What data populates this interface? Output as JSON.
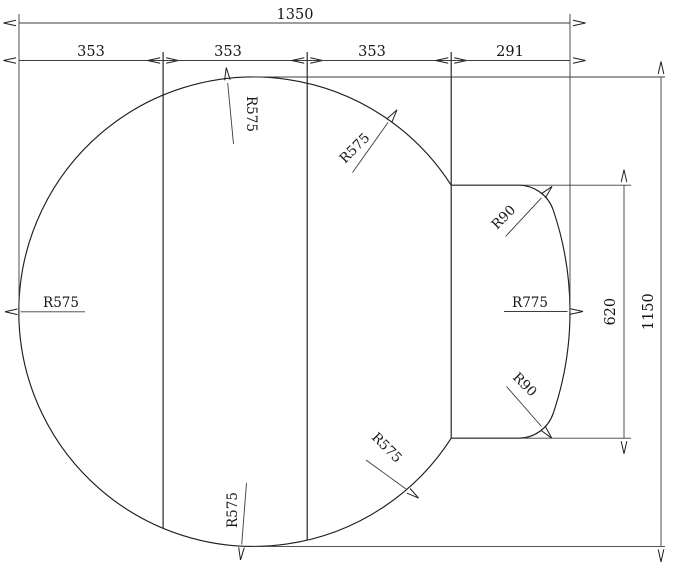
{
  "drawing": {
    "background_color": "#ffffff",
    "line_color": "#1e1e1e",
    "dims": {
      "overall_width": "1350",
      "segment_1": "353",
      "segment_2": "353",
      "segment_3": "353",
      "segment_4": "291",
      "tab_height": "620",
      "overall_height": "1150"
    },
    "radii": {
      "left": "R575",
      "top": "R575",
      "upper_right": "R575",
      "bottom": "R575",
      "lower_right": "R575",
      "bulge": "R775",
      "corner_top": "R90",
      "corner_bottom": "R90"
    }
  }
}
